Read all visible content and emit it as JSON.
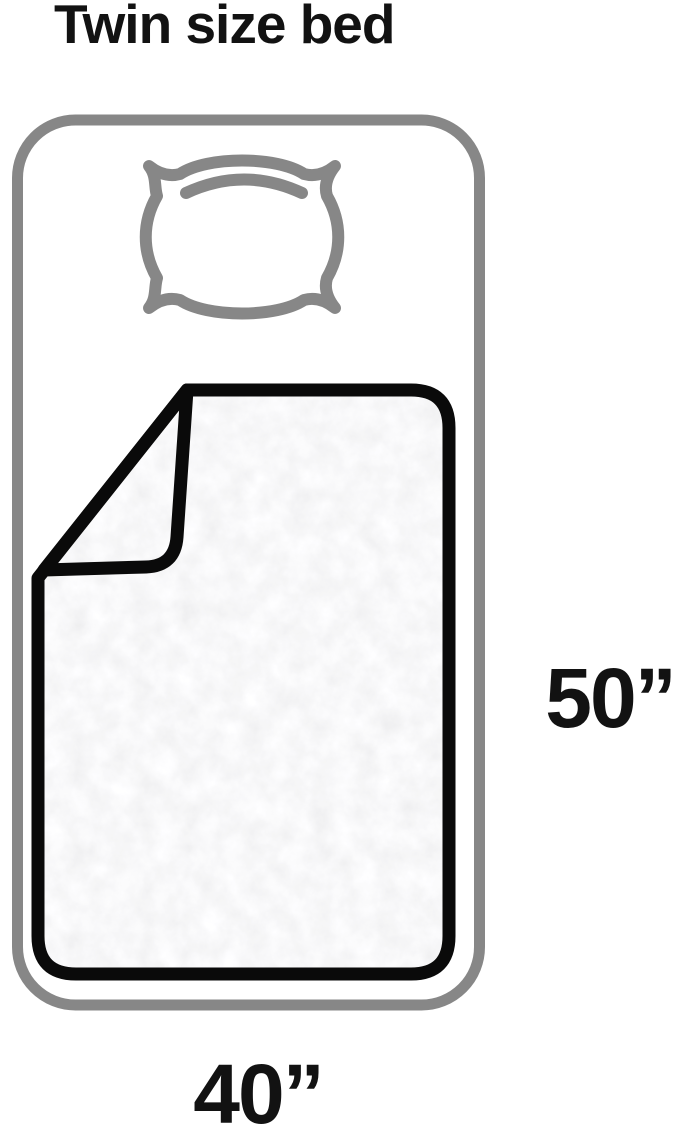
{
  "page": {
    "title": "Twin size bed"
  },
  "diagram": {
    "subject": "twin-size-bed-top-view-with-pillow-and-blanket",
    "dimensions": {
      "height_label": "50”",
      "width_label": "40”",
      "height_inches": 50,
      "width_inches": 40
    },
    "icons": [
      {
        "name": "bed-outline-icon"
      },
      {
        "name": "pillow-icon"
      },
      {
        "name": "blanket-icon"
      }
    ],
    "colors": {
      "background": "#ffffff",
      "text": "#121212",
      "bed_frame_gray": "#878787",
      "pillow_gray": "#878787",
      "blanket_outline": "#0a0a0a",
      "blanket_fill": "#f2f2f2"
    }
  }
}
